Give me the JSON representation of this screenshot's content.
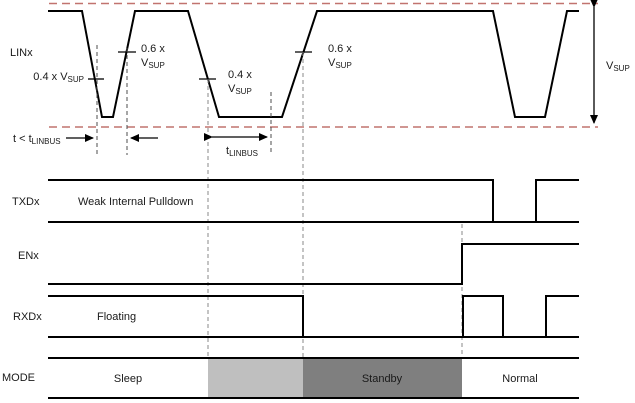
{
  "title": "LIN wake-up timing diagram",
  "colors": {
    "threshold_dashed": "#c1736f",
    "signal_line": "#000000",
    "mode_light_gray": "#bfbfbf",
    "mode_dark_gray": "#7f7f7f"
  },
  "lin": {
    "label": "LINx",
    "thresholds": {
      "fall1_04": {
        "main": "0.4 x V",
        "sub": "SUP"
      },
      "rise1_06": {
        "line1": "0.6 x",
        "v": "V",
        "sub": "SUP"
      },
      "fall2_04": {
        "line1": "0.4 x",
        "v": "V",
        "sub": "SUP"
      },
      "rise2_06": {
        "line1": "0.6 x",
        "v": "V",
        "sub": "SUP"
      }
    },
    "timing": {
      "short_pulse": {
        "main": "t < t",
        "sub": "LINBUS"
      },
      "wake_pulse": {
        "main": "t",
        "sub": "LINBUS"
      }
    },
    "supply": {
      "main": "V",
      "sub": "SUP"
    }
  },
  "txd": {
    "label": "TXDx",
    "note": "Weak Internal Pulldown"
  },
  "en": {
    "label": "ENx"
  },
  "rxd": {
    "label": "RXDx",
    "note": "Floating"
  },
  "mode": {
    "label": "MODE",
    "states": {
      "sleep": "Sleep",
      "standby": "Standby",
      "normal": "Normal"
    }
  }
}
